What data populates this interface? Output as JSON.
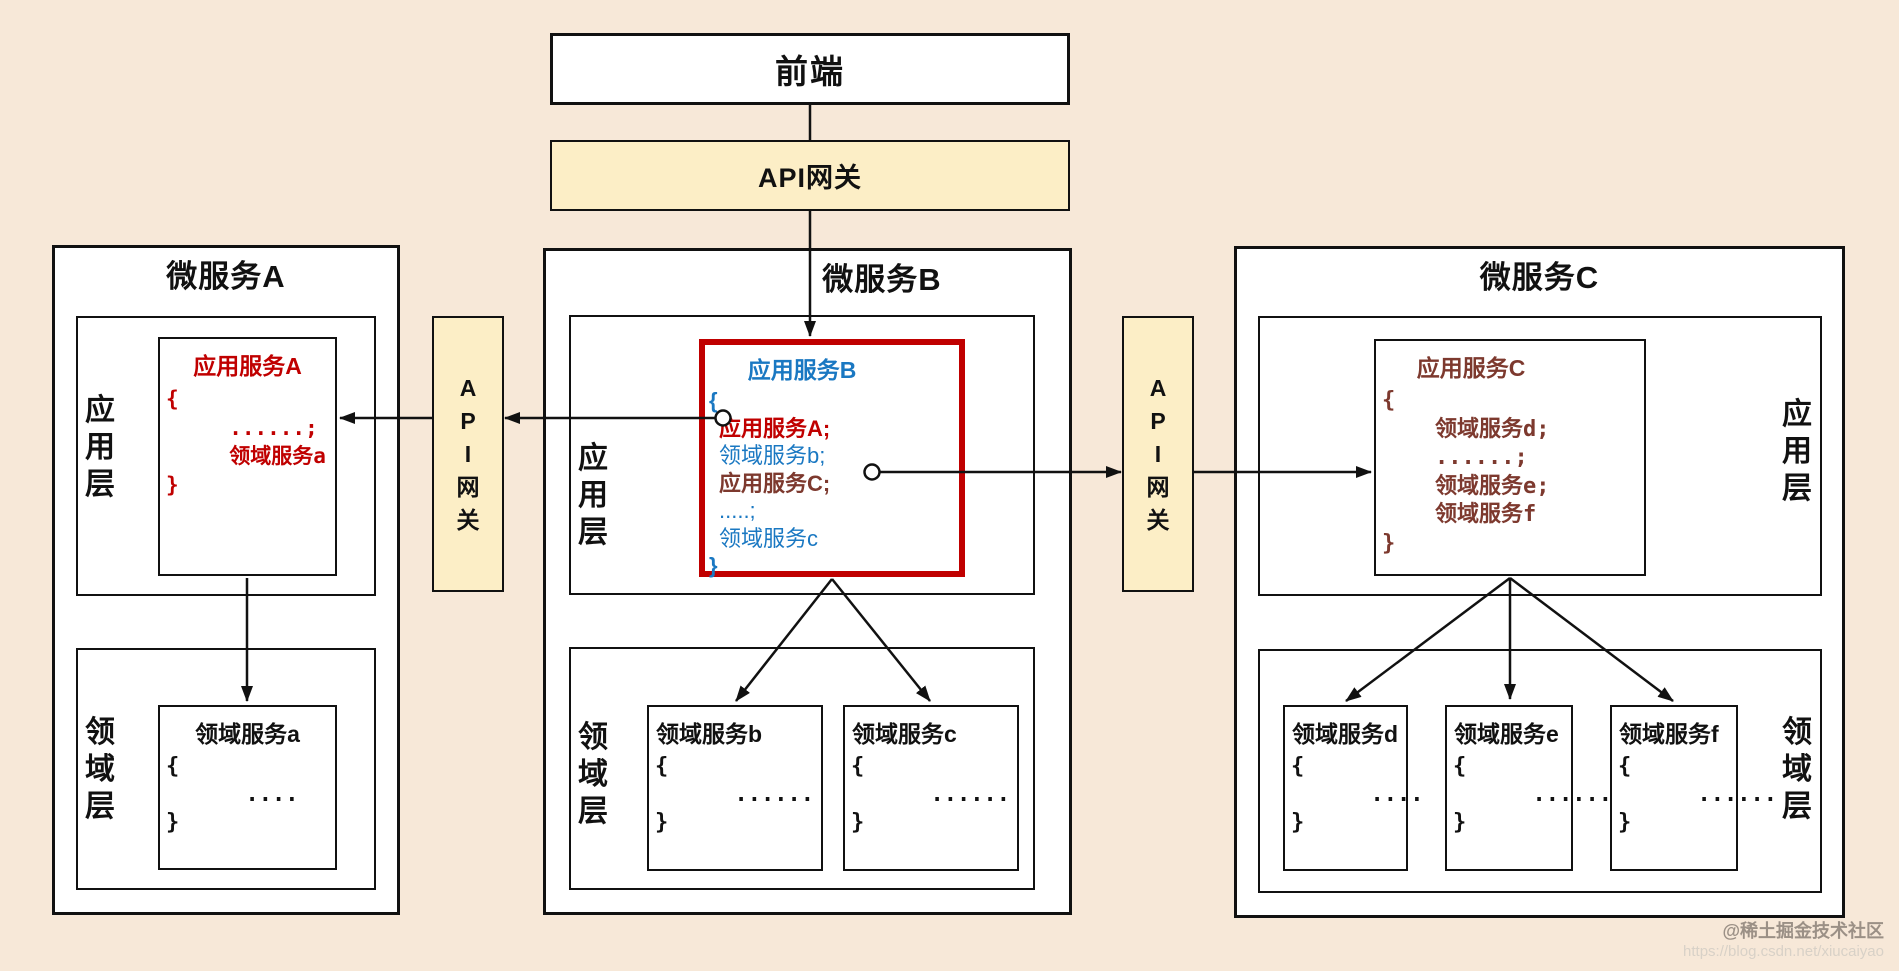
{
  "colors": {
    "background": "#f7e8d8",
    "box_fill": "#ffffff",
    "gateway_fill": "#fceec6",
    "border": "#111111",
    "accent_red": "#c00000",
    "accent_blue": "#1a78c2",
    "accent_maroon": "#7d392e"
  },
  "frontend": {
    "label": "前端"
  },
  "gateway": {
    "top_label": "API网关",
    "left_label": "A\nP\nI\n网\n关",
    "right_label": "A\nP\nI\n网\n关"
  },
  "service_a": {
    "title": "微服务A",
    "app_layer_label": "应\n用\n层",
    "domain_layer_label": "领\n域\n层",
    "app_service": {
      "title": "应用服务A",
      "body": "{\n     ......;\n     领域服务a\n}"
    },
    "domain_service": {
      "title": "领域服务a",
      "body": "{\n      ....\n}"
    }
  },
  "service_b": {
    "title": "微服务B",
    "app_layer_label": "应\n用\n层",
    "domain_layer_label": "领\n域\n层",
    "app_service": {
      "title": "应用服务B",
      "lines": [
        "{",
        "应用服务A;",
        "领域服务b;",
        "应用服务C;",
        ".....;",
        "领域服务c",
        "}"
      ]
    },
    "domain_services": [
      {
        "title": "领域服务b",
        "body": "{\n      ......\n}"
      },
      {
        "title": "领域服务c",
        "body": "{\n      ......\n}"
      }
    ]
  },
  "service_c": {
    "title": "微服务C",
    "app_layer_label": "应\n用\n层",
    "domain_layer_label": "领\n域\n层",
    "app_service": {
      "title": "应用服务C",
      "body": "{\n    领域服务d;\n    ......;\n    领域服务e;\n    领域服务f\n}"
    },
    "domain_services": [
      {
        "title": "领域服务d",
        "body": "{\n      ....\n}"
      },
      {
        "title": "领域服务e",
        "body": "{\n      ......\n}"
      },
      {
        "title": "领域服务f",
        "body": "{\n      ......\n}"
      }
    ]
  },
  "watermark": {
    "line1": "@稀土掘金技术社区",
    "line2": "https://blog.csdn.net/xiucaiyao"
  }
}
